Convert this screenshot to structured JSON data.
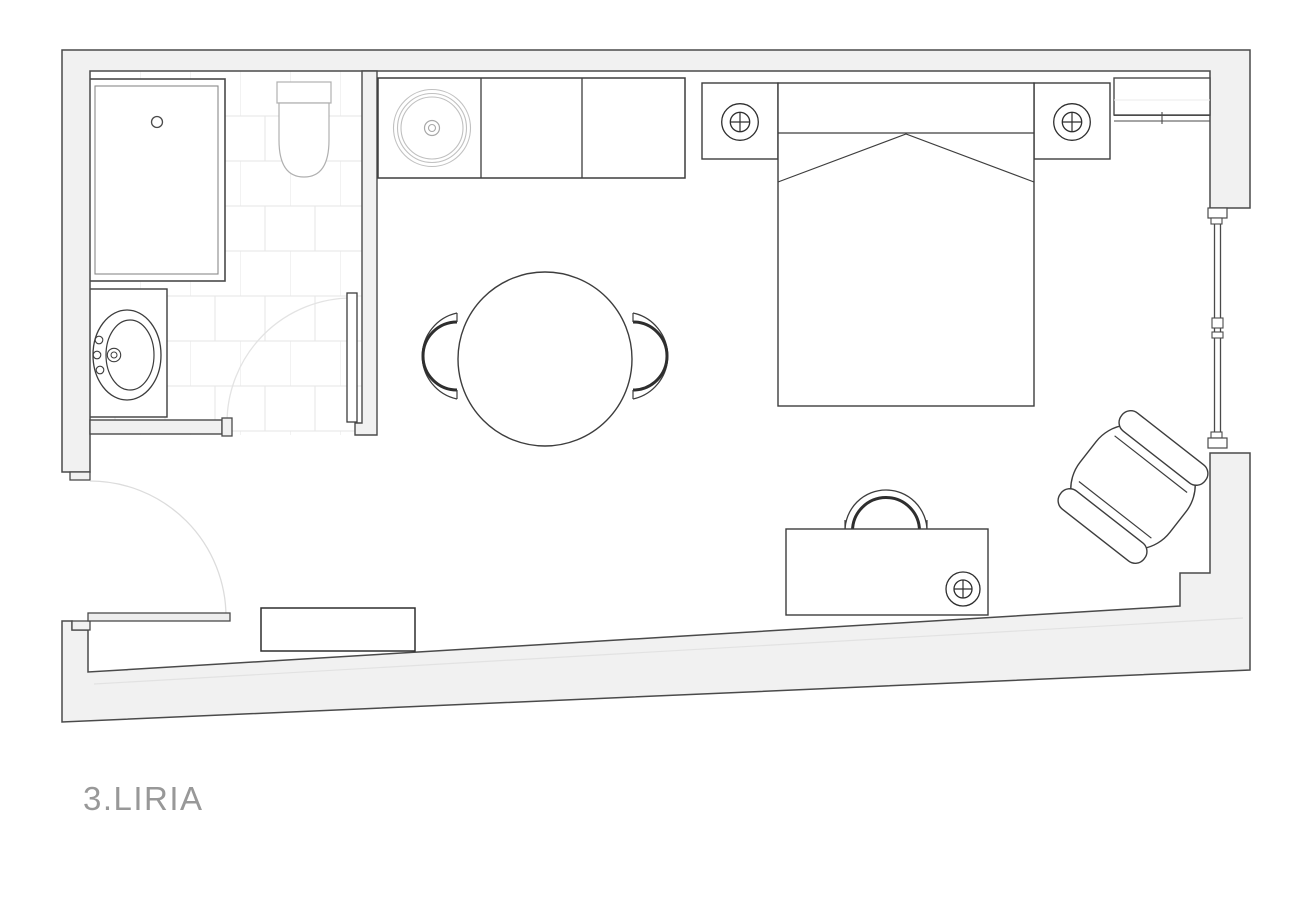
{
  "title": {
    "label": "3.LIRIA"
  },
  "plan": {
    "type": "hotel-room-floor-plan",
    "room_elements": [
      "bathtub",
      "toilet",
      "sink-vanity",
      "bathroom-tiled-floor",
      "bathroom-door",
      "entry-door",
      "kitchen-counter",
      "kitchen-round-sink",
      "dining-table",
      "dining-chair-left",
      "dining-chair-right",
      "bed",
      "pillow-line",
      "blanket-fold",
      "nightstand-left",
      "nightstand-right",
      "lamp-symbol-left",
      "lamp-symbol-right",
      "closet-top-right",
      "window-right",
      "desk",
      "desk-chair",
      "desk-lamp-symbol",
      "armchair",
      "entry-bench",
      "sloped-exterior-wall"
    ],
    "colors": {
      "background": "#ffffff",
      "wall_fill": "#f1f1f1",
      "wall_stroke": "#4a4a4a",
      "furniture_stroke": "#3d3d3d",
      "fixture_light": "#b3b3b3",
      "tile_line": "#e9e9e9",
      "door_swing_arc": "#dedede",
      "label_text": "#989898"
    }
  }
}
